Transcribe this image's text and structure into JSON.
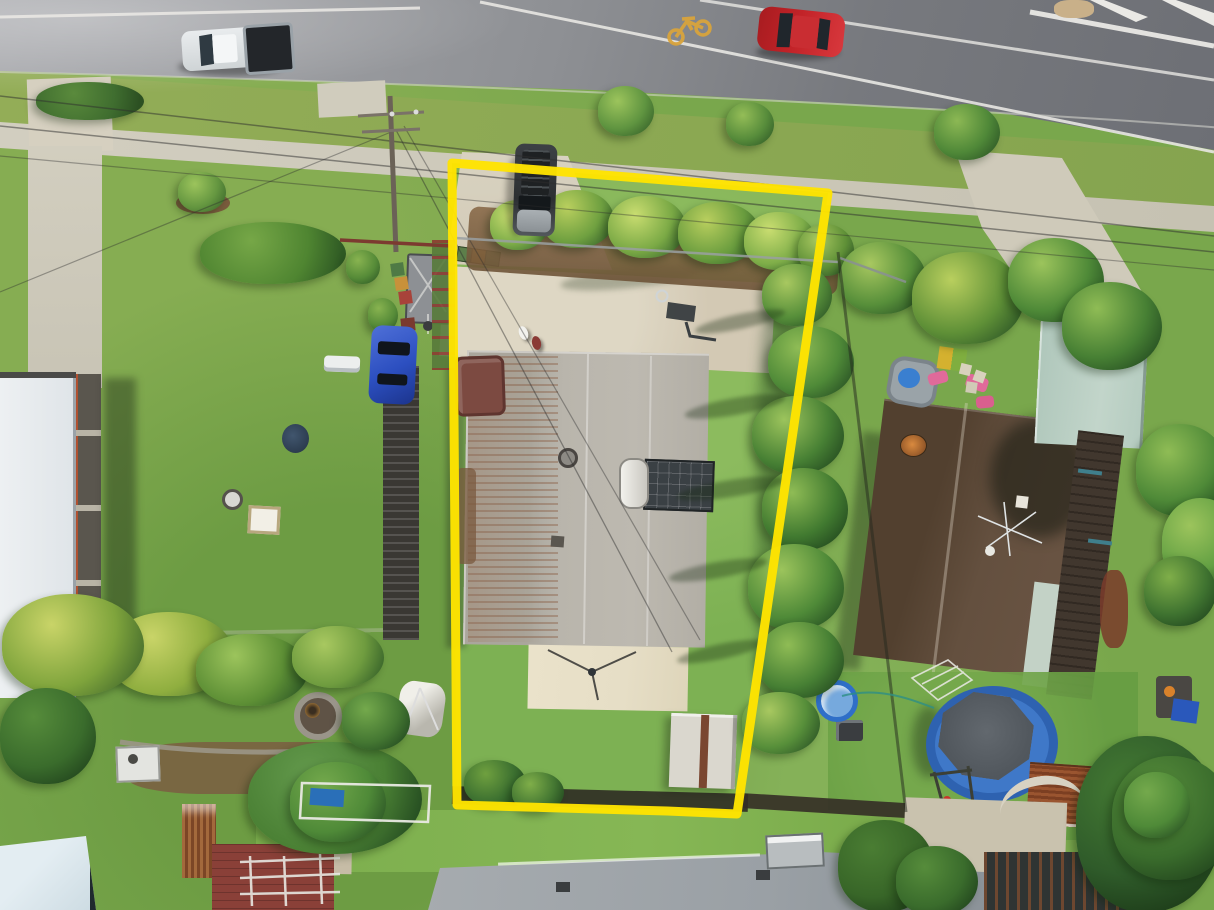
{
  "meta": {
    "description": "Aerial drone photograph of a suburban residential block; a yellow outline highlights the boundary of the subject property with a metal-roof house, long concrete driveway, palm-lined borders, lawn and a garden shed, between two neighbouring houses, fronting a main road.",
    "visible_text": "none"
  },
  "palette": {
    "lawn": "#79a74c",
    "lawn-subject": "#83b256",
    "lawn-back": "#7fb14f",
    "verge": "#8fae56",
    "road-light": "#a9aaae",
    "road-dark": "#6d6f75",
    "footpath": "#cdc9ba",
    "concrete": "#d6d0c0",
    "drive": "#d9d2bf",
    "boundary-yellow": "#ffe400",
    "bike-yellow": "#d9a43c",
    "roof-subject": "#b5b1a8",
    "rust": "#8a5c3c",
    "roof-left": "#6b6761",
    "roof-right": "#5a4638",
    "roof-green": "#b7cdc2",
    "roof-white": "#e9edf0",
    "roof-lightblue": "#ccdbe2",
    "roof-bottom": "#9aa0a5",
    "pergola": "#3a3833",
    "walkway": "#5a564e",
    "patio-cream": "#e6dec6",
    "shed-white": "#dad7ce",
    "shed-rust-a": "#9a5530",
    "shed-rust-b": "#7c3f22",
    "spa-maroon": "#7c4a41",
    "pool-ring": "#2e62b0",
    "pool-water": "#3f78c8",
    "pool-cover": "#51575d",
    "kiddie-pool": "#76a9dd",
    "ute-white": "#e9ecee",
    "car-red": "#c22328",
    "car-blue": "#2c4fc0",
    "suv-dark": "#3d4145",
    "mulch": "#84653f",
    "tree-dark": "#2e5c28",
    "tree-mid": "#4f8a38",
    "tree-light": "#79ad4a",
    "tree-yellow": "#a8bf52",
    "stone": "#9b9687",
    "firepit-amber": "#c89040",
    "brick": "#8a4038",
    "fence-dark": "#2c2822",
    "fence-maroon": "#7c3a30",
    "deck-dark": "#41372e",
    "solar-panel": "#3a4044"
  },
  "scene": {
    "road": {
      "surface": "asphalt",
      "markings": [
        "white-lane-lines",
        "bike-lane-symbol",
        "chevron-median-island",
        "kerb-line"
      ],
      "vehicles": [
        {
          "name": "white-ute",
          "color": "#e9ecee",
          "detail": "black tonneau tray, parked at kerb"
        },
        {
          "name": "red-sedan",
          "color": "#c22328",
          "detail": "travelling on road"
        }
      ]
    },
    "streetscape": [
      "grass-verge",
      "concrete-footpath",
      "street-trees",
      "power-pole",
      "overhead-wires",
      "driveway-crossovers"
    ],
    "subject_property": {
      "outline_color": "#ffe400",
      "features": [
        "concrete-driveway",
        "dark-suv-parked",
        "wheelie-bins",
        "palm-front-garden",
        "corrugated-metal-roof-house",
        "rust-streaked-roof",
        "solar-panel",
        "hot-water-cylinder",
        "maroon-spa",
        "cream-patio",
        "tv-antenna",
        "basketball-hoop",
        "palm-row-east-boundary",
        "garden-shed",
        "rear-timber-fence",
        "lawn",
        "two-people-on-driveway"
      ]
    },
    "left_neighbor": {
      "features": [
        "dark-grey-corrugated-roof",
        "skylight",
        "satellite-dish",
        "slatted-pergola",
        "blue-hatchback",
        "tarped-trailer",
        "wheelie-bins",
        "long-concrete-driveway",
        "white-roof-outbuilding",
        "side-walkway",
        "fire-pit",
        "rock-garden-border",
        "small-white-shed",
        "teepee-tent",
        "palms"
      ]
    },
    "right_neighbor": {
      "features": [
        "brown-tile-roof",
        "orange-satellite-dish",
        "tv-antenna",
        "pale-green-garage-roof",
        "pale-green-roof-section",
        "side-deck",
        "kids-play-area",
        "paddling-pool",
        "pink-toys",
        "clothesline",
        "above-ground-pool-with-cover",
        "kiddie-pool",
        "swing-set",
        "rusty-shed",
        "garden-table",
        "dense-trees"
      ]
    },
    "bottom_neighbors": {
      "features": [
        "light-blue-gable-roof",
        "rusty-corrugated-panel",
        "brick-patio",
        "white-pergola-frame",
        "grey-metal-roof-house",
        "soccer-goal",
        "garden-path",
        "stone-retaining-wall",
        "dark-outbuilding",
        "boat-trailer"
      ]
    }
  }
}
